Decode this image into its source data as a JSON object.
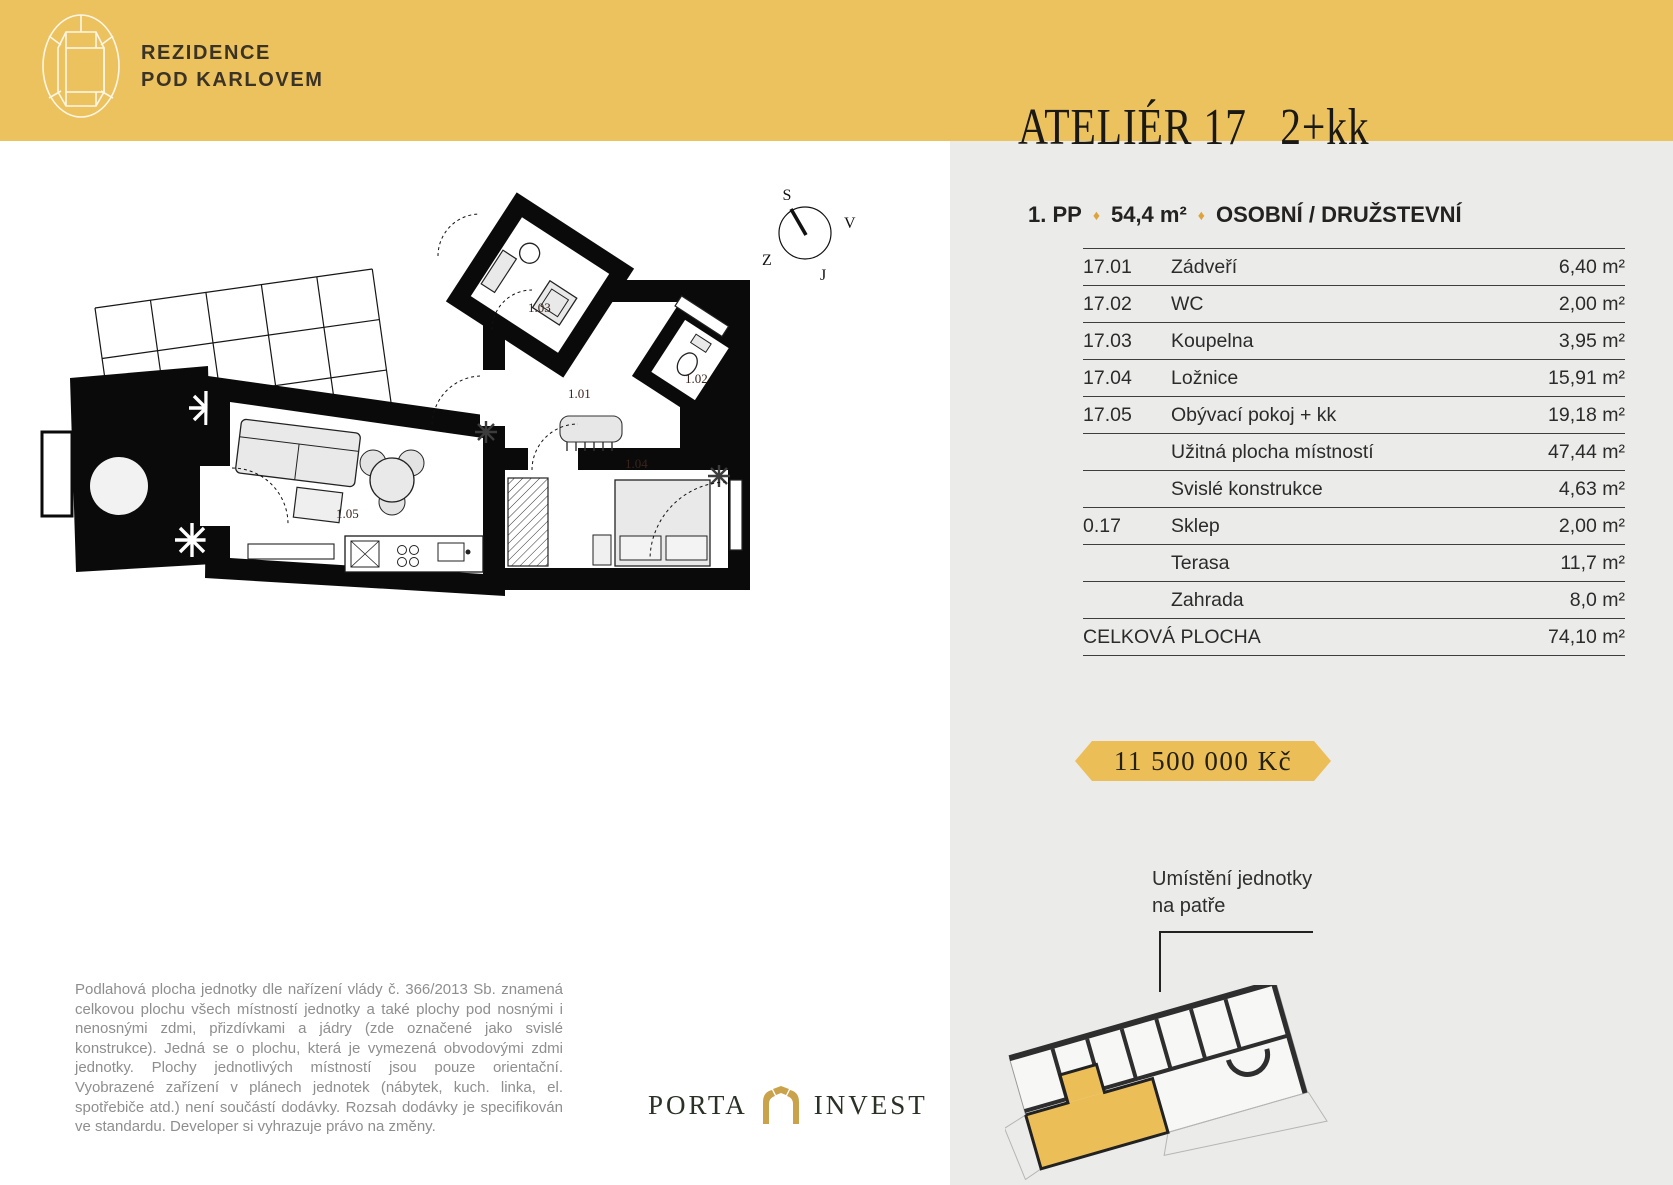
{
  "brand": {
    "line1": "REZIDENCE",
    "line2": "POD KARLOVEM"
  },
  "unit": {
    "name": "ATELIÉR 17",
    "layout": "2+kk",
    "floor": "1. PP",
    "area": "54,4 m²",
    "ownership": "OSOBNÍ / DRUŽSTEVNÍ"
  },
  "icons": {
    "diamond": "♦"
  },
  "table": {
    "rows": [
      {
        "code": "17.01",
        "name": "Zádveří",
        "area": "6,40 m²"
      },
      {
        "code": "17.02",
        "name": "WC",
        "area": "2,00 m²"
      },
      {
        "code": "17.03",
        "name": "Koupelna",
        "area": "3,95 m²"
      },
      {
        "code": "17.04",
        "name": "Ložnice",
        "area": "15,91 m²"
      },
      {
        "code": "17.05",
        "name": "Obývací pokoj + kk",
        "area": "19,18 m²"
      },
      {
        "code": "",
        "name": "Užitná plocha místností",
        "area": "47,44 m²"
      },
      {
        "code": "",
        "name": "Svislé konstrukce",
        "area": "4,63 m²"
      },
      {
        "code": "0.17",
        "name": "Sklep",
        "area": "2,00 m²"
      },
      {
        "code": "",
        "name": "Terasa",
        "area": "11,7 m²"
      },
      {
        "code": "",
        "name": "Zahrada",
        "area": "8,0 m²"
      }
    ],
    "total_label": "CELKOVÁ PLOCHA",
    "total_value": "74,10 m²"
  },
  "price": {
    "value": "11 500 000 Kč"
  },
  "placement": {
    "line1": "Umístění jednotky",
    "line2": "na patře"
  },
  "compass": {
    "north": "S",
    "east": "V",
    "west": "Z",
    "south": "J"
  },
  "floorplan": {
    "room_labels": {
      "r101": "1.01",
      "r102": "1.02",
      "r103": "1.03",
      "r104": "1.04",
      "r105": "1.05"
    }
  },
  "disclaimer": "Podlahová plocha jednotky dle nařízení vlády č. 366/2013 Sb. znamená celkovou plochu všech místností jednotky a také plochy pod nosnými i nenosnými zdmi, přizdívkami a jádry (zde označené jako svislé konstrukce). Jedná se o plochu, která je vymezená obvodovými zdmi jednotky. Plochy jednotlivých místností jsou pouze orientační. Vyobrazené zařízení v plánech jednotek (nábytek, kuch. linka, el. spotřebiče atd.) není součástí dodávky. Rozsah dodávky je specifikován ve standardu. Developer si vyhrazuje právo na změny.",
  "footer_logo": {
    "left": "PORTA",
    "right": "INVEST"
  },
  "colors": {
    "accent_yellow": "#ECC25F",
    "badge_yellow": "#ECBE58",
    "panel_gray": "#EBEBEA",
    "gold": "#DFA33C",
    "porta_green": "#2A3227",
    "porta_gold": "#C9A24B",
    "disclaimer_gray": "#8E8E8E"
  }
}
